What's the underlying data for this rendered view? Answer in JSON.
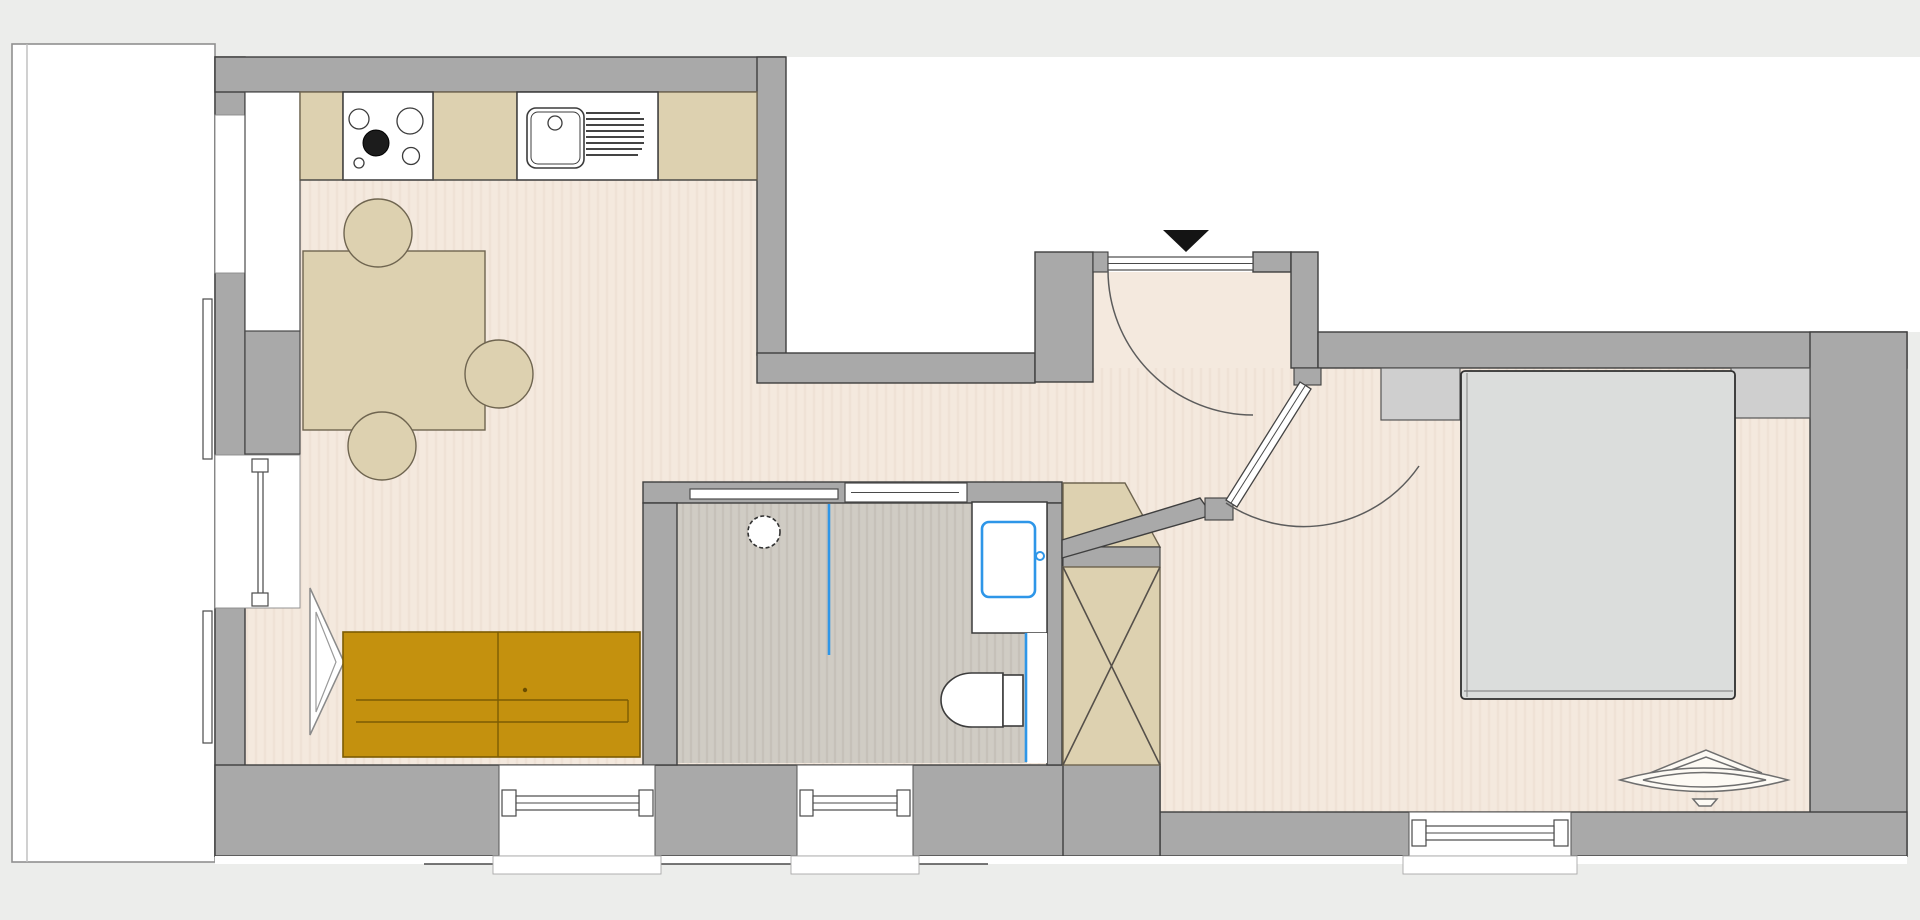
{
  "meta": {
    "title": "Apartment floor plan",
    "view": "top-down architectural plan",
    "canvas": {
      "width": 1920,
      "height": 920
    }
  },
  "colors": {
    "bg": "#ecedeb",
    "white": "#ffffff",
    "wall": "#a9a9a9",
    "wall_stroke": "#3f3f3f",
    "floor": "#f4e9de",
    "bath_floor": "#d0ccc4",
    "tan": "#ddd1b0",
    "sofa": "#c4910e",
    "sofa_stroke": "#7c5c03",
    "bed": "#dbdddc",
    "closet": "#cfcfcf",
    "blue": "#2e96e8",
    "marker_black": "#141414"
  },
  "rooms": [
    {
      "id": "kitchen-living",
      "label": "Kitchen / Living room"
    },
    {
      "id": "hallway",
      "label": "Entrance hall"
    },
    {
      "id": "bathroom",
      "label": "Bathroom"
    },
    {
      "id": "bedroom",
      "label": "Bedroom"
    },
    {
      "id": "balcony",
      "label": "Balcony / terrace"
    }
  ],
  "fixtures": {
    "kitchen": {
      "counter_segments": 5,
      "cooktop_burners": 4,
      "sink": "square sink with drainboard",
      "tall_cabinet": "white column"
    },
    "dining": {
      "table": "square table",
      "chairs": 3
    },
    "living": {
      "sofa": "ochre two-seat sofa",
      "floor_lamp": "triangular kite decor"
    },
    "bathroom": {
      "shower_drain": 1,
      "glass_partition": "blue line",
      "washbasin": "blue outlined basin",
      "toilet": 1,
      "sliding_door": "pocket door, two panels"
    },
    "storage": {
      "x_braced_cabinet": 1,
      "corner_shelf": "tan trapezoid"
    },
    "bedroom": {
      "bed": "double bed",
      "wardrobe_segments": 2,
      "decor": "boat / leaf shaped object"
    }
  },
  "openings": {
    "entry_door": {
      "swing": "inward, hinge right",
      "marker": "black triangle above opening"
    },
    "bedroom_door": {
      "orientation": "diagonal 45deg",
      "swing": "into bedroom hall corner"
    },
    "windows_left_wall": 2,
    "windows_bottom_wall": 3
  }
}
